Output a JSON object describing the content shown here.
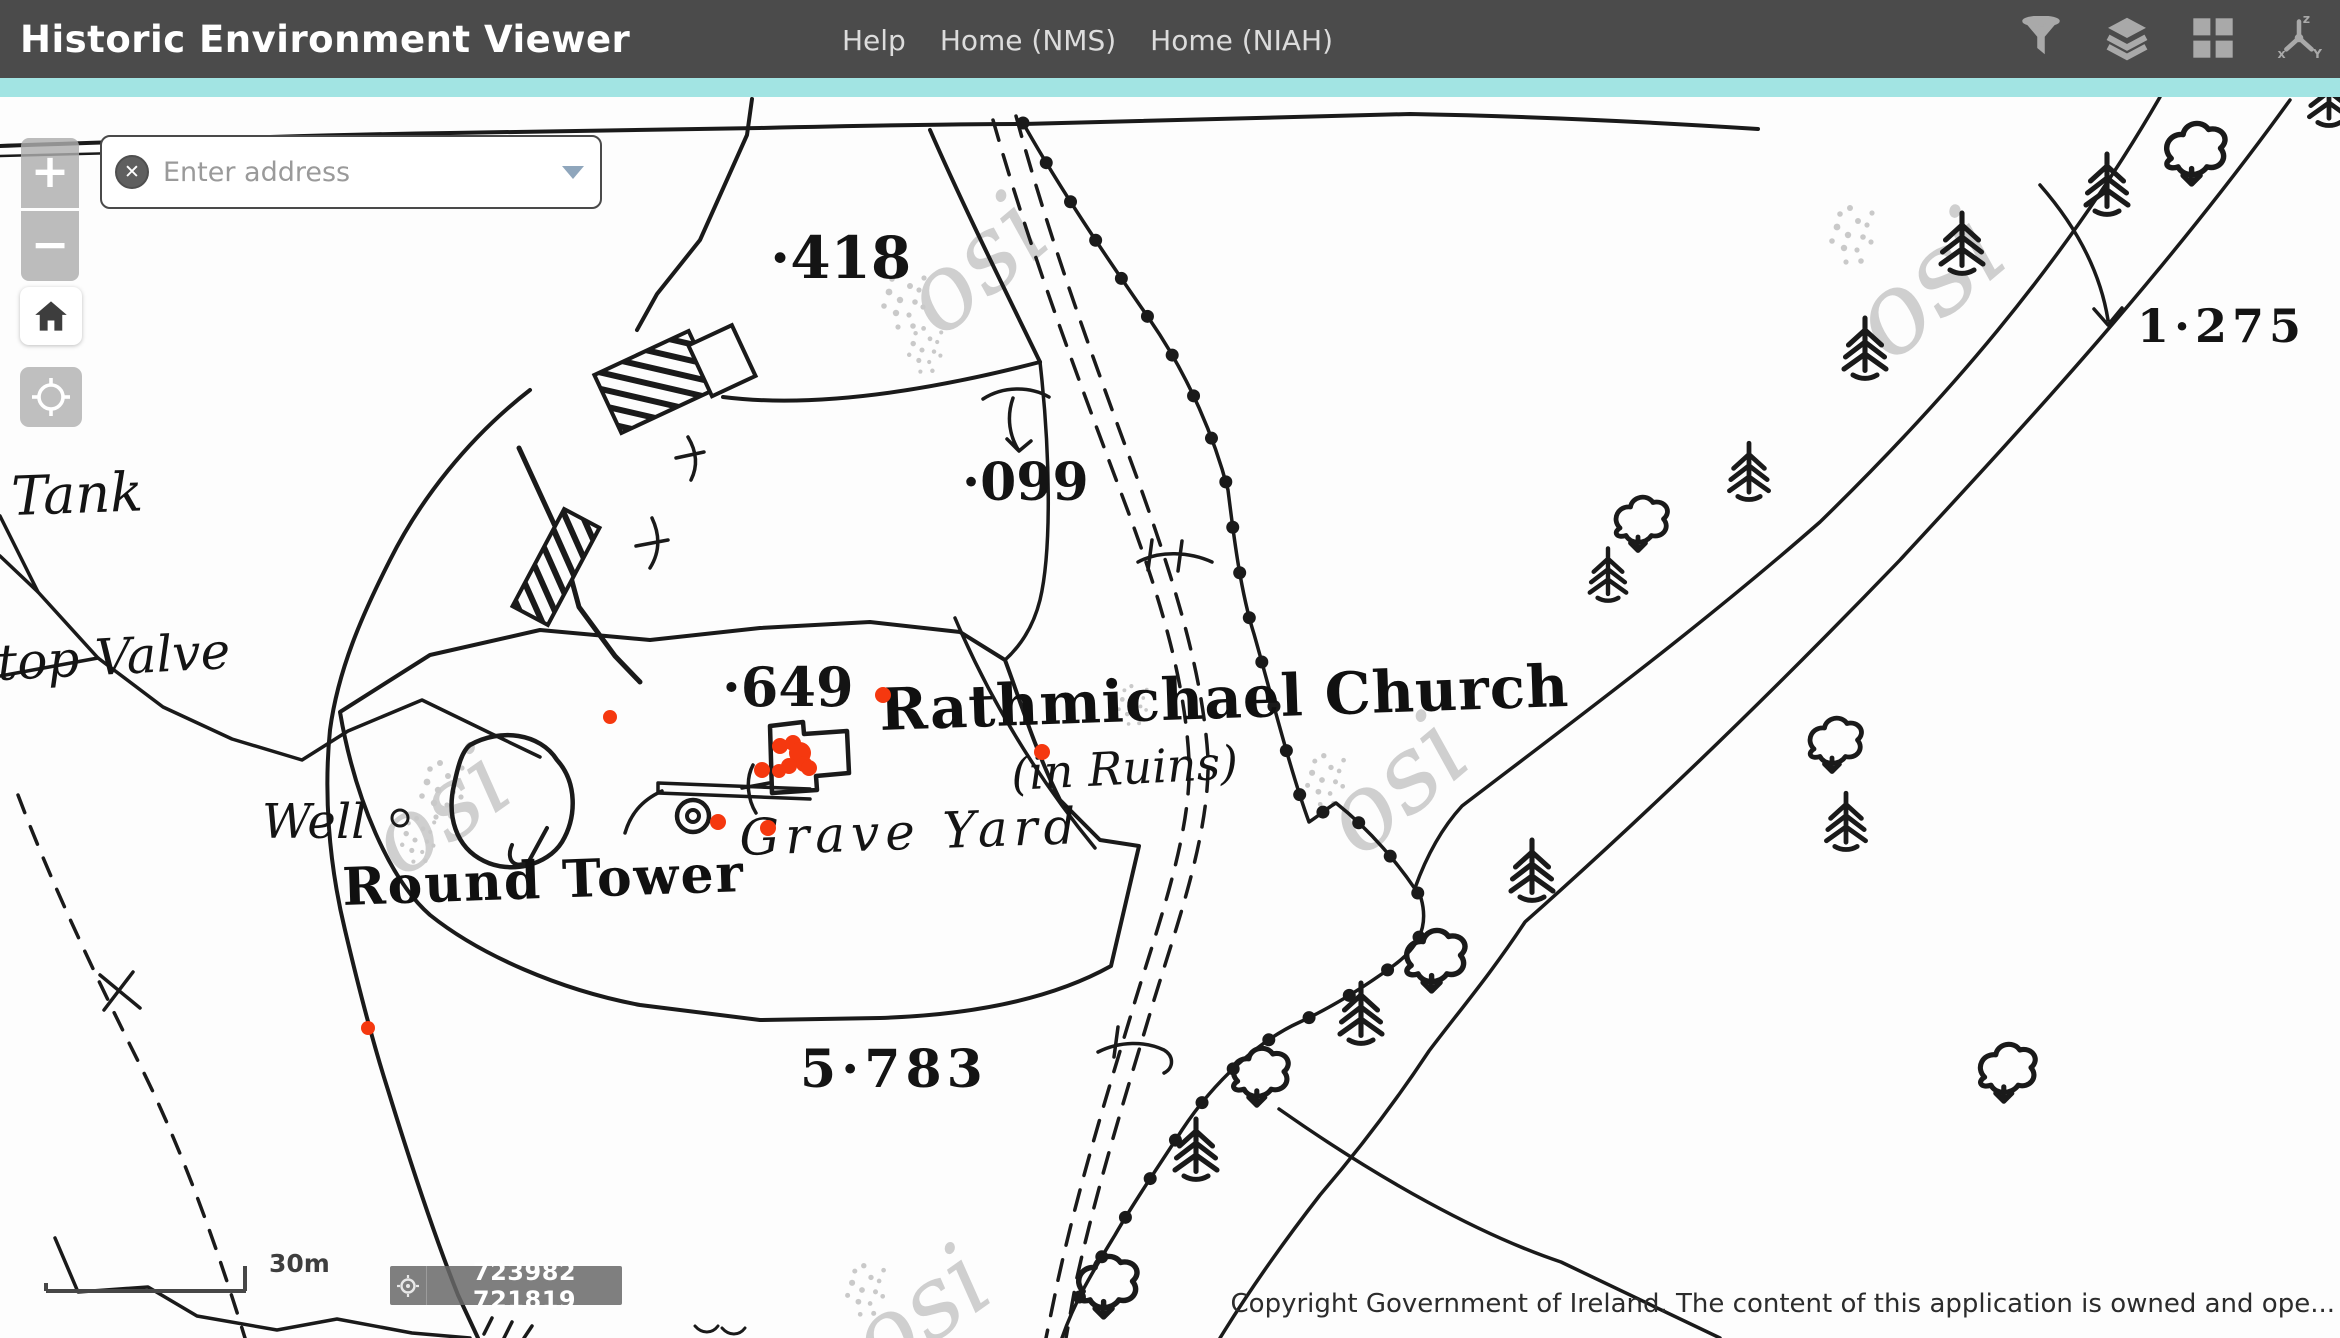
{
  "header": {
    "title": "Historic Environment Viewer",
    "nav": [
      {
        "label": "Help"
      },
      {
        "label": "Home (NMS)"
      },
      {
        "label": "Home (NIAH)"
      }
    ],
    "colors": {
      "bar": "#4b4b4b",
      "accent": "#a2e4e3",
      "icon": "#a9a9a9"
    }
  },
  "search": {
    "placeholder": "Enter address",
    "clear_icon": "✕"
  },
  "controls": {
    "zoom_in": "+",
    "zoom_out": "−"
  },
  "map": {
    "labels": {
      "tank": "Tank",
      "top_valve": "top Valve",
      "well": "Well",
      "round_tower": "Round Tower",
      "church": "Rathmichael Church",
      "in_ruins": "(in Ruins)",
      "grave_yard": "Grave Yard",
      "spot_418": "·418",
      "spot_099": "·099",
      "spot_649": "·649",
      "area_5783": "5·783",
      "area_1275": "1·275",
      "watermark": "osi"
    },
    "monuments": {
      "color": "#f5380f",
      "points": [
        [
          610,
          717,
          7
        ],
        [
          883,
          695,
          8
        ],
        [
          1042,
          752,
          8
        ],
        [
          780,
          746,
          8
        ],
        [
          793,
          743,
          8
        ],
        [
          800,
          753,
          11
        ],
        [
          804,
          764,
          8
        ],
        [
          789,
          766,
          8
        ],
        [
          762,
          770,
          8
        ],
        [
          779,
          771,
          7
        ],
        [
          809,
          768,
          8
        ],
        [
          718,
          822,
          8
        ],
        [
          768,
          828,
          8
        ],
        [
          368,
          1028,
          7
        ]
      ]
    },
    "scalebar": {
      "label": "30m"
    },
    "coordinates": {
      "value": "723982 721819"
    },
    "copyright": "Copyright Government of Ireland. The content of this application is owned and ope..."
  }
}
